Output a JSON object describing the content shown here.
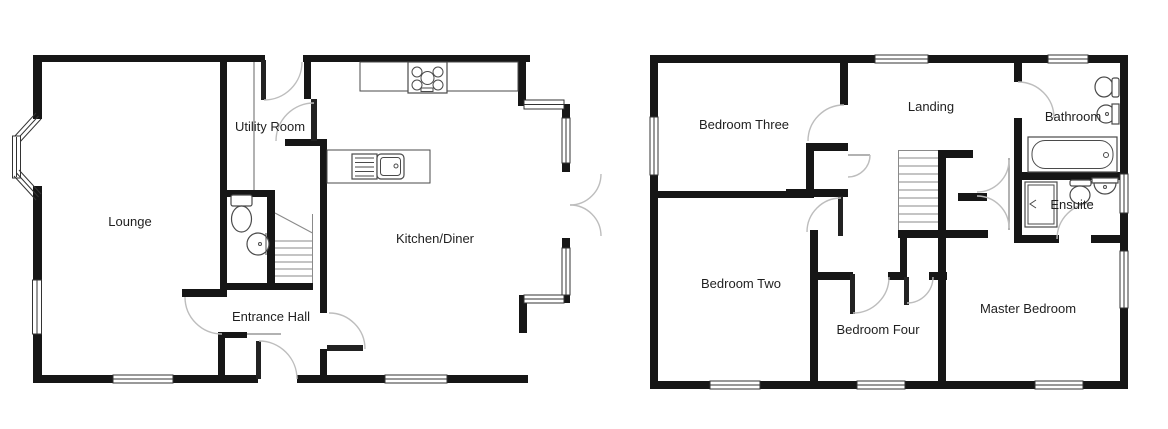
{
  "plan_title": "Two storey house floor plan",
  "colors": {
    "wall": "#161616",
    "door_arc": "#bdbdbd",
    "fixture_outline": "#4a4a4a",
    "text": "#1f1f1f"
  },
  "ground_floor": {
    "rooms": {
      "lounge": "Lounge",
      "utility": "Utility Room",
      "kitchen": "Kitchen/Diner",
      "hall": "Entrance Hall"
    },
    "fixtures": [
      "hob",
      "worktop",
      "sink-unit",
      "toilet",
      "basin",
      "staircase",
      "bay-window",
      "french-doors"
    ]
  },
  "first_floor": {
    "rooms": {
      "bedroom_three": "Bedroom Three",
      "landing": "Landing",
      "bathroom": "Bathroom",
      "ensuite": "Ensuite",
      "bedroom_two": "Bedroom Two",
      "bedroom_four": "Bedroom Four",
      "master": "Master Bedroom"
    },
    "fixtures": [
      "bathtub",
      "toilet",
      "basin",
      "shower",
      "toilet",
      "basin",
      "staircase",
      "airing-cupboard"
    ]
  }
}
